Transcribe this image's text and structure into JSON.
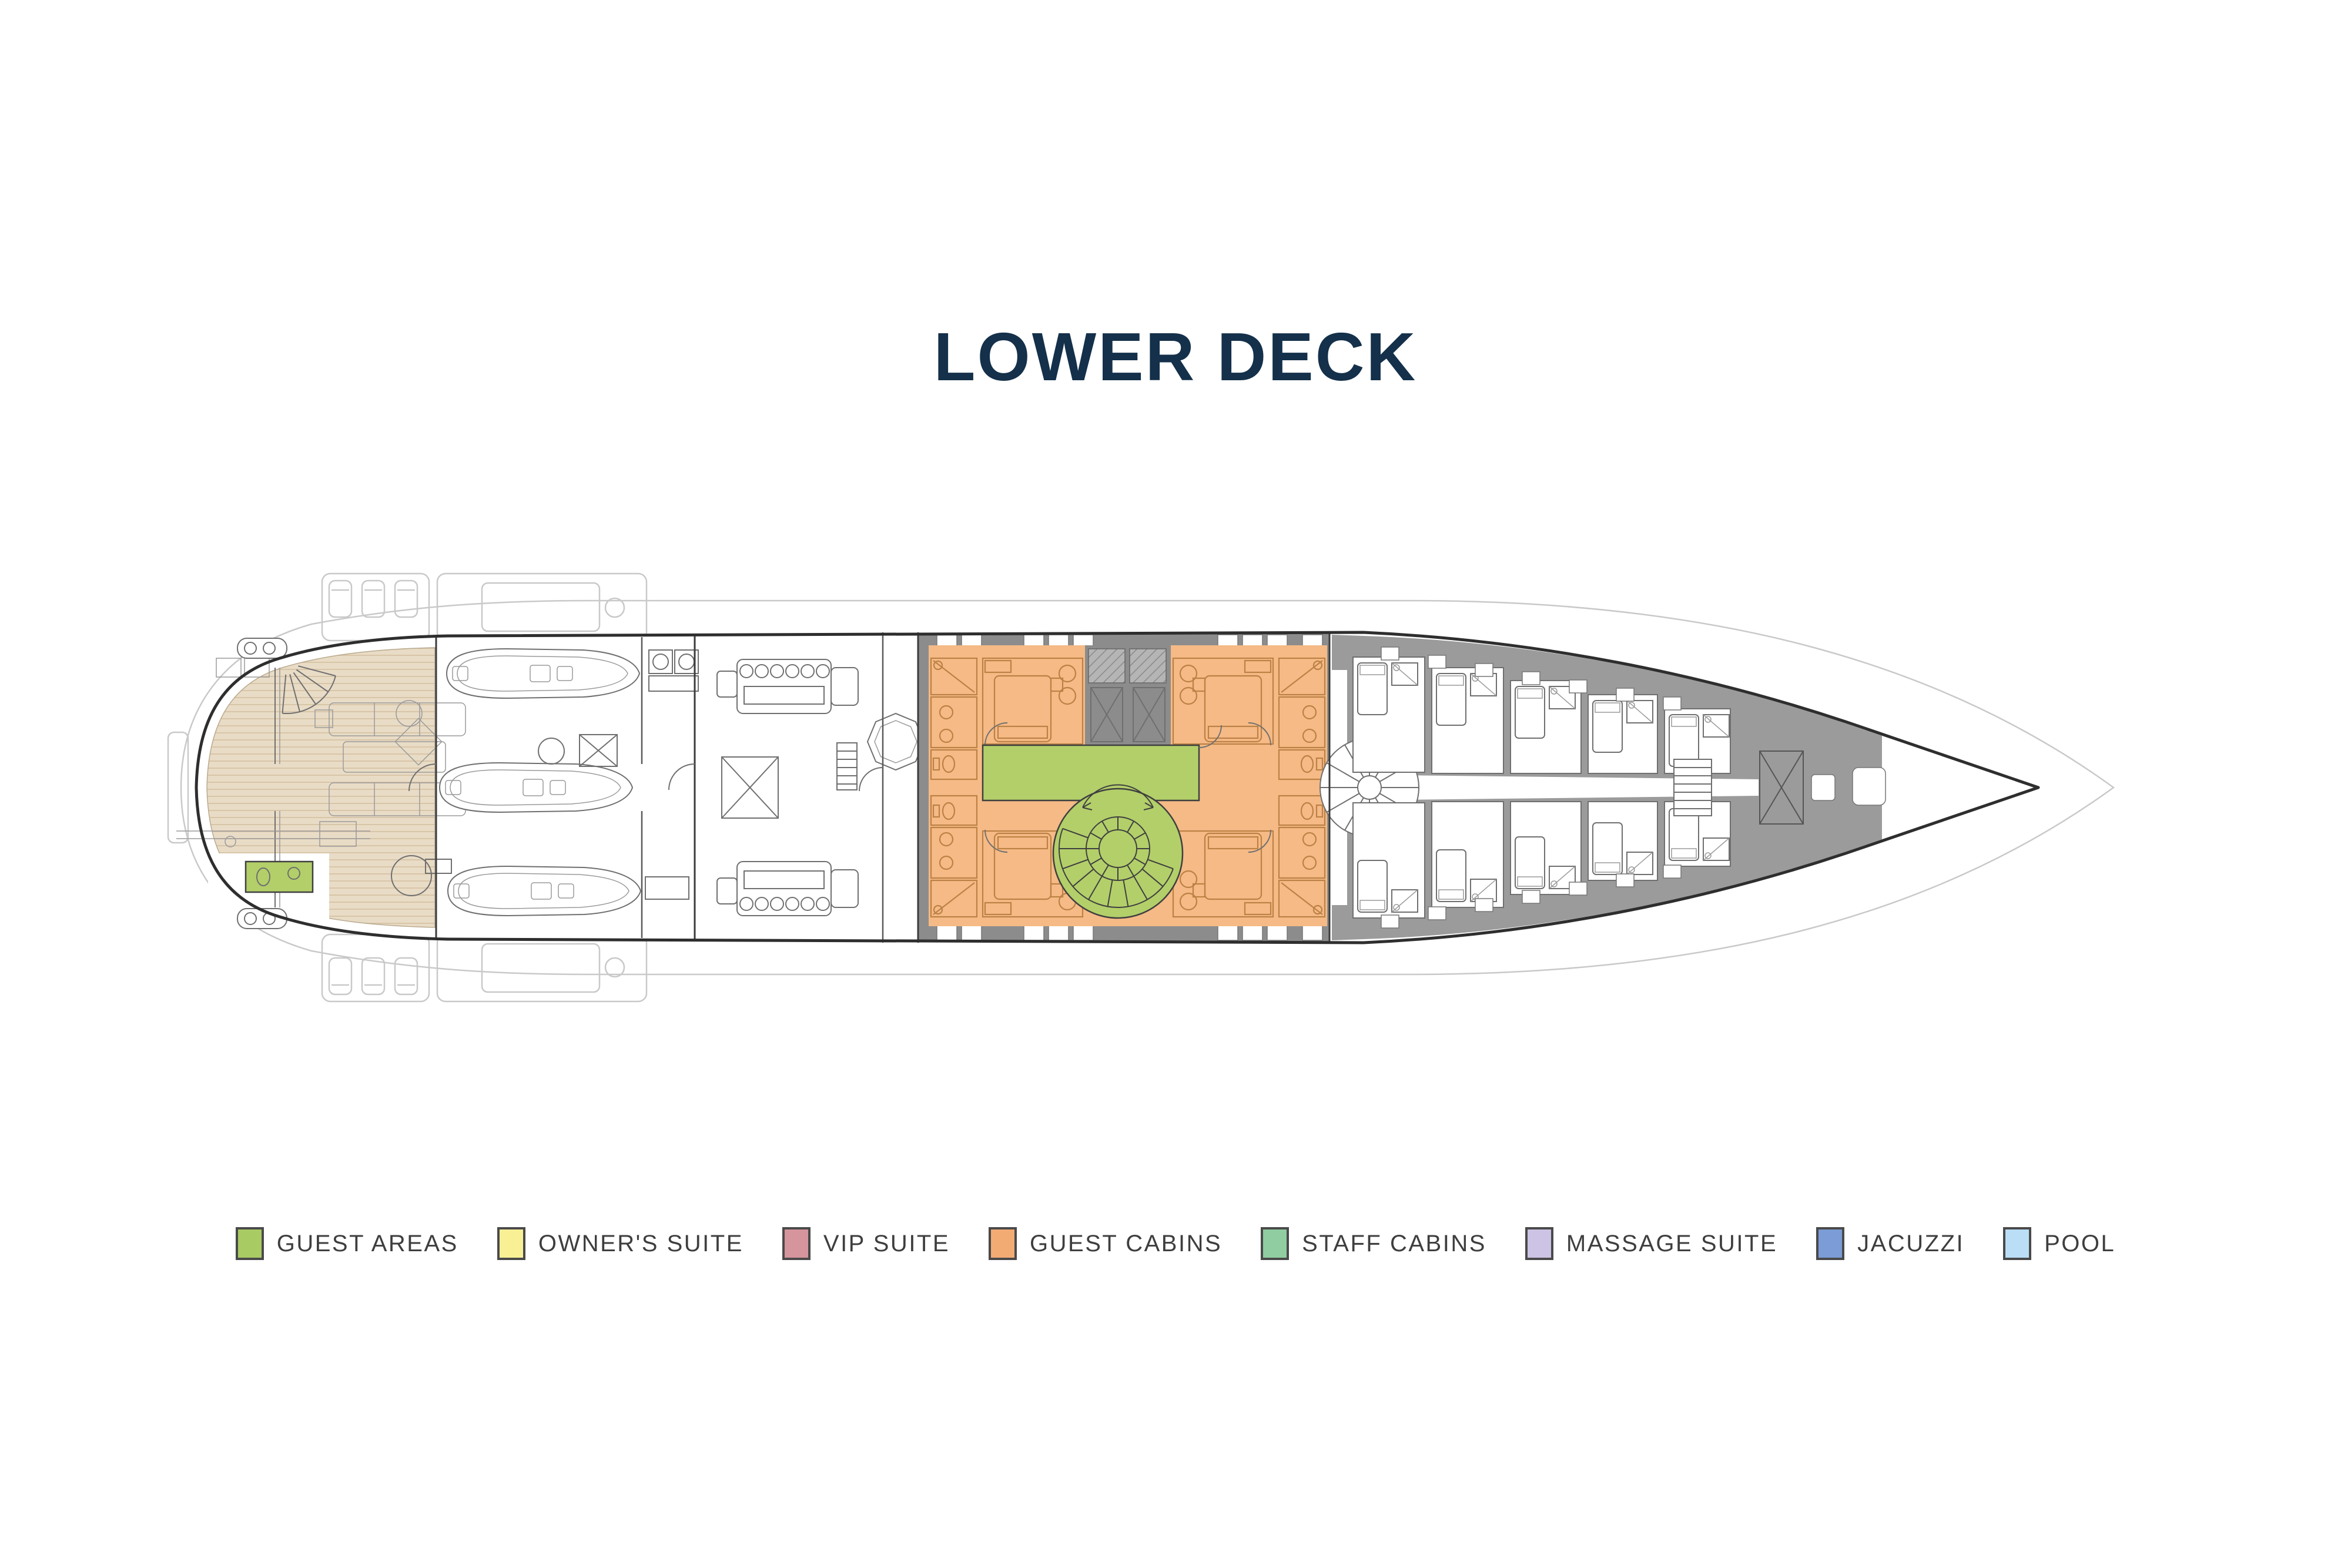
{
  "title": {
    "text": "LOWER DECK",
    "color": "#14304a"
  },
  "legend": {
    "swatch_border": "#4a4a4a",
    "label_color": "#3e3e3e",
    "items": [
      {
        "id": "guest-areas",
        "label": "GUEST AREAS",
        "color": "#a9cb63"
      },
      {
        "id": "owners-suite",
        "label": "OWNER'S SUITE",
        "color": "#f9f095"
      },
      {
        "id": "vip-suite",
        "label": "VIP SUITE",
        "color": "#d6959d"
      },
      {
        "id": "guest-cabins",
        "label": "GUEST CABINS",
        "color": "#f3ab74"
      },
      {
        "id": "staff-cabins",
        "label": "STAFF CABINS",
        "color": "#90cda1"
      },
      {
        "id": "massage-suite",
        "label": "MASSAGE SUITE",
        "color": "#cdc3e4"
      },
      {
        "id": "jacuzzi",
        "label": "JACUZZI",
        "color": "#7b9cd6"
      },
      {
        "id": "pool",
        "label": "POOL",
        "color": "#badef6"
      }
    ]
  },
  "plan": {
    "deck_name": "Lower Deck",
    "zone_colors": {
      "guest_area_green": "#b3cf6a",
      "guest_cabin_orange": "#f5ba86",
      "cabin_line_orange": "#bc8144",
      "wall_gray": "#8c8c8c",
      "crew_gray": "#9b9b9b",
      "deck_tan": "#e9dcc6",
      "deck_tan_stripe": "#d8c5a8",
      "hull_line": "#2e2e2e",
      "ghost_line": "#c9c9c9",
      "detail_line": "#6f6f6f"
    },
    "zones": [
      {
        "id": "beach-club-lounge",
        "category": "guest-area-decking"
      },
      {
        "id": "aft-day-head",
        "category": "guest-areas"
      },
      {
        "id": "tender-garage",
        "category": "technical"
      },
      {
        "id": "engine-room",
        "category": "technical"
      },
      {
        "id": "guest-cabin-port-aft",
        "category": "guest-cabins"
      },
      {
        "id": "guest-cabin-starboard-aft",
        "category": "guest-cabins"
      },
      {
        "id": "guest-cabin-port-fwd",
        "category": "guest-cabins"
      },
      {
        "id": "guest-cabin-starboard-fwd",
        "category": "guest-cabins"
      },
      {
        "id": "guest-lobby",
        "category": "guest-areas"
      },
      {
        "id": "guest-spiral-staircase",
        "category": "guest-areas"
      },
      {
        "id": "crew-quarters",
        "category": "crew"
      },
      {
        "id": "bow-stores",
        "category": "crew"
      }
    ]
  }
}
